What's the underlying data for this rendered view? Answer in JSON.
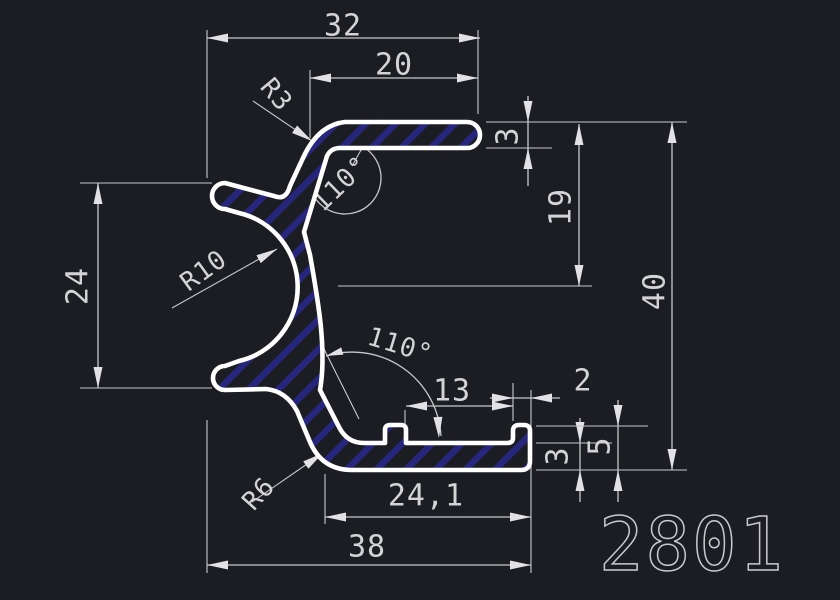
{
  "drawing": {
    "part_number": "2801"
  },
  "dimensions": {
    "overall_width_top": "32",
    "top_arm_length": "20",
    "top_fillet_radius": "R3",
    "top_angle": "110°",
    "top_arm_thickness": "3",
    "right_height_19": "19",
    "overall_height": "40",
    "left_opening_height": "24",
    "socket_radius": "R10",
    "bottom_angle": "110°",
    "bottom_length_13": "13",
    "lip_thickness": "2",
    "lip_height": "5",
    "bottom_wall_thickness": "3",
    "bottom_fillet_radius": "R6",
    "bottom_inner_length": "24,1",
    "overall_width_bottom": "38"
  },
  "colors": {
    "background": "#1b1d23",
    "profile_outline": "#ffffff",
    "hatch_stripes": "#26267c",
    "dimension_lines": "#c8c8cc",
    "text": "#d4d4d6"
  }
}
